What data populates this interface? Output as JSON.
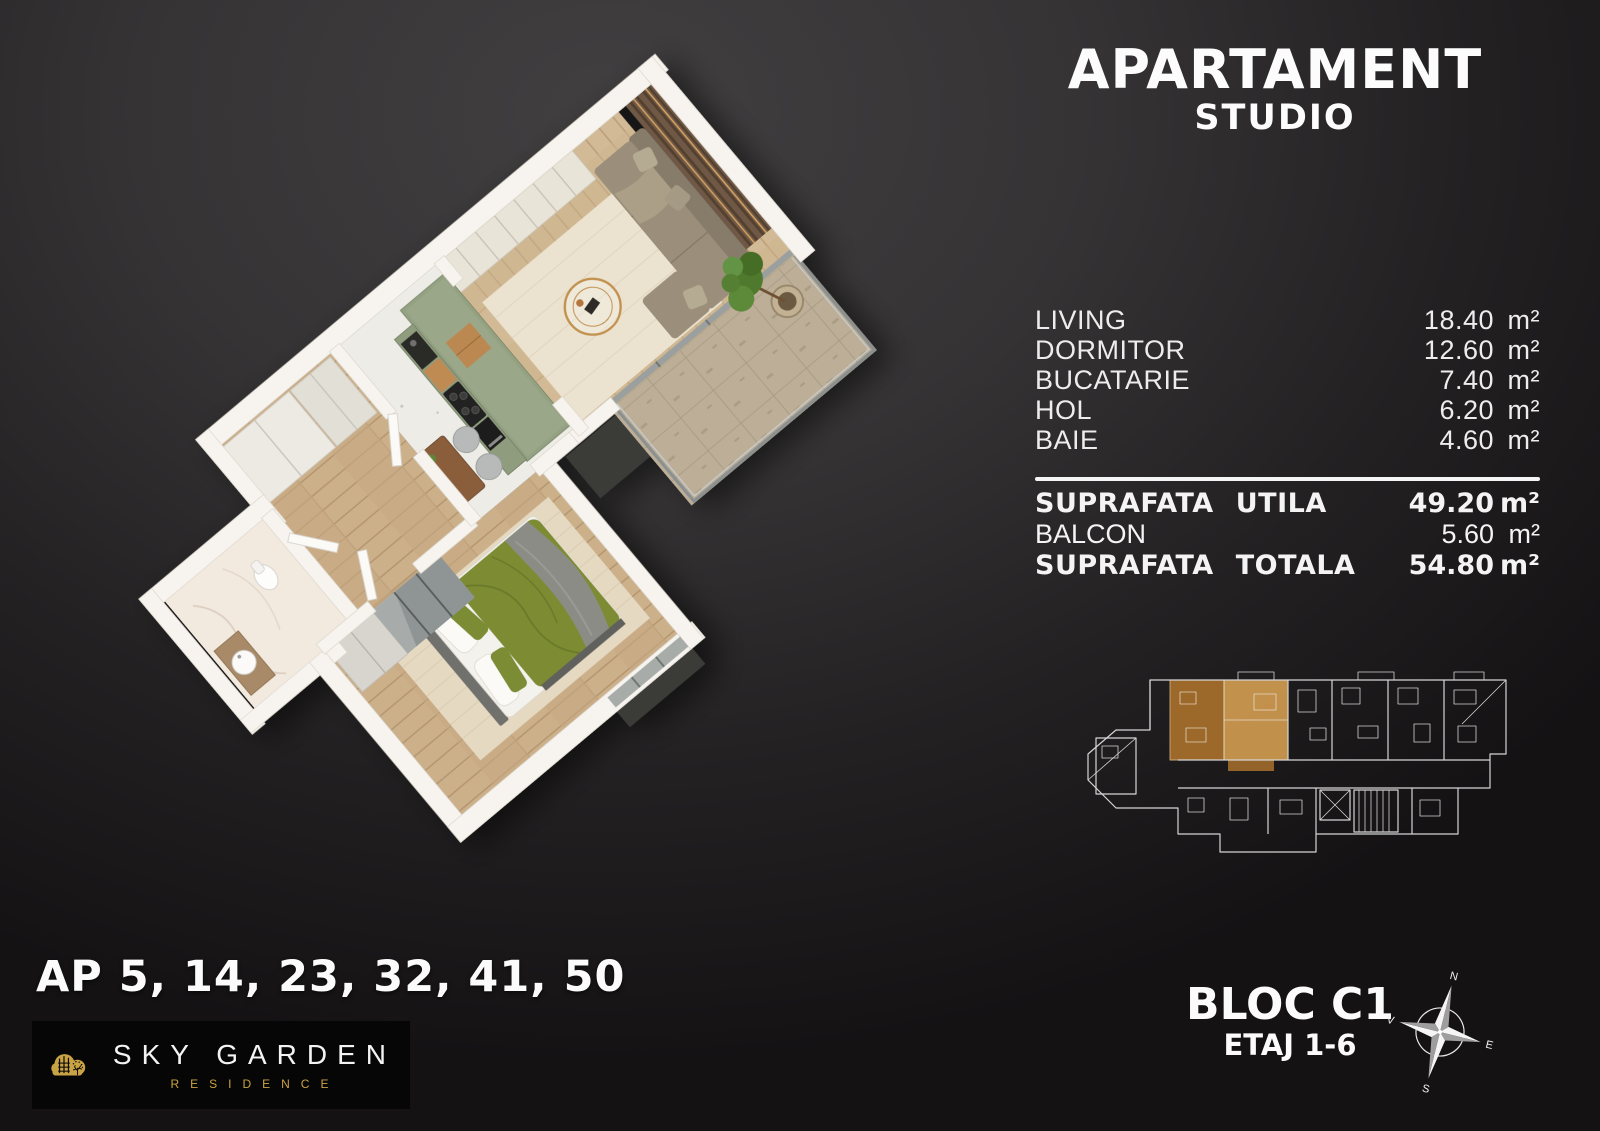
{
  "title": {
    "line1": "APARTAMENT",
    "line2": "STUDIO"
  },
  "area_table": {
    "rows": [
      {
        "label": "LIVING",
        "value": "18.40",
        "unit": "m²"
      },
      {
        "label": "DORMITOR",
        "value": "12.60",
        "unit": "m²"
      },
      {
        "label": "BUCATARIE",
        "value": "7.40",
        "unit": "m²"
      },
      {
        "label": "HOL",
        "value": "6.20",
        "unit": "m²"
      },
      {
        "label": "BAIE",
        "value": "4.60",
        "unit": "m²"
      }
    ],
    "totals": [
      {
        "label": "SUPRAFATA UTILA",
        "value": "49.20",
        "unit": "m²",
        "emphasis": true
      },
      {
        "label": "BALCON",
        "value": "5.60",
        "unit": "m²",
        "emphasis": false
      },
      {
        "label": "SUPRAFATA TOTALA",
        "value": "54.80",
        "unit": "m²",
        "emphasis": true
      }
    ]
  },
  "apartments_line": "AP 5, 14, 23, 32, 41, 50",
  "logo": {
    "brand": "SKY GARDEN",
    "sub": "RESIDENCE"
  },
  "block_info": {
    "line1": "BLOC C1",
    "line2": "ETAJ 1-6"
  },
  "compass": {
    "north": "N",
    "east": "E",
    "south": "S",
    "west": "V"
  },
  "colors": {
    "background_dark": "#141213",
    "text_white": "#fcfcfc",
    "logo_gold": "#c9a244",
    "overview_highlight": "#cf9a4e",
    "kitchen_green": "#95a183",
    "bed_green": "#7d8c33",
    "wall_white": "#f7f4ef"
  }
}
